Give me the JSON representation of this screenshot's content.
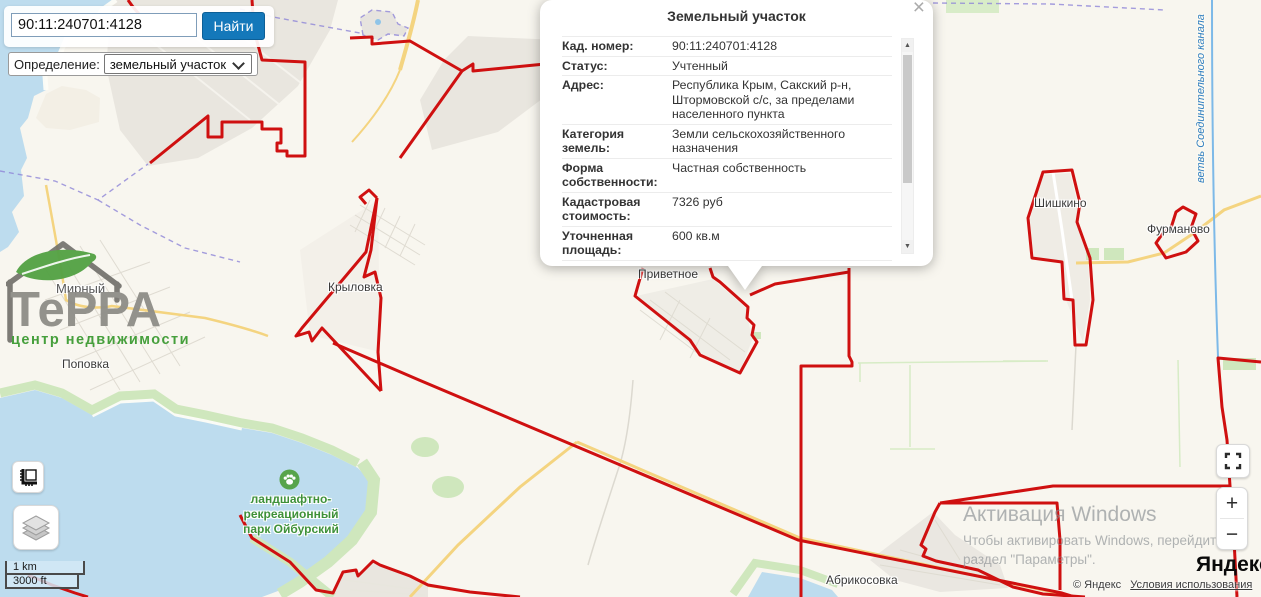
{
  "search": {
    "query": "90:11:240701:4128",
    "button_label": "Найти",
    "definition_label": "Определение:",
    "definition_value": "земельный участок"
  },
  "popup": {
    "title": "Земельный участок",
    "close_icon": "×",
    "scroll_up": "▲",
    "scroll_down": "▼",
    "fields": [
      {
        "label": "Кад. номер:",
        "value": "90:11:240701:4128"
      },
      {
        "label": "Статус:",
        "value": "Учтенный"
      },
      {
        "label": "Адрес:",
        "value": "Республика Крым, Сакский р-н, Штормовской с/с, за пределами населенного пункта"
      },
      {
        "label": "Категория земель:",
        "value": "Земли сельскохозяйственного назначения"
      },
      {
        "label": "Форма собственности:",
        "value": "Частная собственность"
      },
      {
        "label": "Кадастровая стоимость:",
        "value": "7326 руб"
      },
      {
        "label": "Уточненная площадь:",
        "value": "600 кв.м"
      }
    ]
  },
  "logo": {
    "brand": "ТеРРА",
    "tagline": "центр недвижимости"
  },
  "map": {
    "place_labels": [
      {
        "id": "mirny",
        "text": "Мирный"
      },
      {
        "id": "popovka",
        "text": "Поповка"
      },
      {
        "id": "krylovka",
        "text": "Крыловка"
      },
      {
        "id": "privetnoe",
        "text": "Приветное"
      },
      {
        "id": "shishkino",
        "text": "Шишкино"
      },
      {
        "id": "furmanovo",
        "text": "Фурманово"
      },
      {
        "id": "abrikosovka",
        "text": "Абрикосовка"
      }
    ],
    "park_label": {
      "line1": "ландшафтно-",
      "line2": "рекреационный",
      "line3": "парк Ойбурский"
    },
    "canal_label": "ветвь Соединительного канала"
  },
  "controls": {
    "zoom_in": "+",
    "zoom_out": "−",
    "scale_km": "1 km",
    "scale_ft": "3000 ft"
  },
  "watermark": {
    "title": "Активация Windows",
    "line1": "Чтобы активировать Windows, перейдите в",
    "line2": "раздел \"Параметры\"."
  },
  "attribution": {
    "brand": "Яндекс",
    "copyright": "© Яндекс",
    "terms_link": "Условия использования"
  },
  "colors": {
    "boundary_red": "#cf1010",
    "water_blue": "#bddcee",
    "park_green": "#cfe7bd",
    "road_yellow": "#f4d480",
    "button_blue": "#1478ba",
    "park_label_green": "#3e9139",
    "canal_label_blue": "#2d7dc0"
  }
}
